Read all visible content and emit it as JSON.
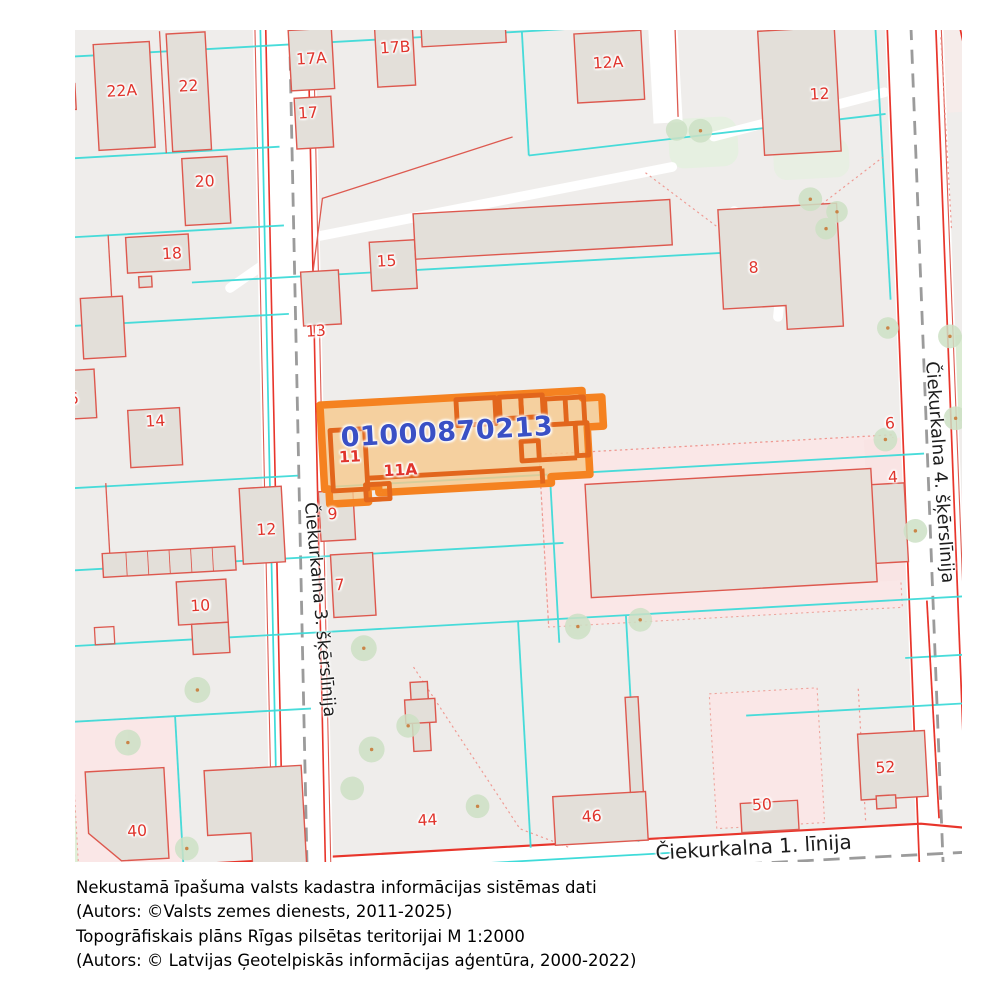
{
  "map": {
    "selected_parcel": {
      "cadastre_number": "01000870213",
      "house_numbers": [
        "11",
        "11A"
      ]
    },
    "streets": {
      "street_3": "Čiekurkalna 3. šķērslīnija",
      "street_4": "Čiekurkalna 4. šķērslīnija",
      "street_1": "Čiekurkalna 1. līnija"
    },
    "labels": [
      {
        "text": "22A"
      },
      {
        "text": "22"
      },
      {
        "text": "17A"
      },
      {
        "text": "17B"
      },
      {
        "text": "17"
      },
      {
        "text": "20"
      },
      {
        "text": "18"
      },
      {
        "text": "12A"
      },
      {
        "text": "12"
      },
      {
        "text": "15"
      },
      {
        "text": "13"
      },
      {
        "text": "8"
      },
      {
        "text": "16"
      },
      {
        "text": "14"
      },
      {
        "text": "7"
      },
      {
        "text": "6"
      },
      {
        "text": "4"
      },
      {
        "text": "9"
      },
      {
        "text": "7"
      },
      {
        "text": "12"
      },
      {
        "text": "10"
      },
      {
        "text": "11"
      },
      {
        "text": "11A"
      },
      {
        "text": "40"
      },
      {
        "text": "42"
      },
      {
        "text": "44"
      },
      {
        "text": "46"
      },
      {
        "text": "50"
      },
      {
        "text": "52"
      }
    ],
    "colors": {
      "highlight_border": "#F58220",
      "highlight_fill": "#F6C98E",
      "highlight_inner_lines": "#E2661C",
      "cadastre_text": "#3A50C5",
      "house_number_text": "#E0342C",
      "parcel_line_red": "#DD5A50",
      "street_line_red": "#E8352B",
      "survey_line_cyan": "#3FDBD9",
      "road_fill": "#FFFFFF",
      "road_dash_gray": "#9B9B9B",
      "background": "#EFEDEB",
      "building_fill": "#E3DFD9",
      "green_area": "#DFEED6",
      "pink_area": "#FAE7E7",
      "tree_fill": "#CDE1C5"
    }
  },
  "attribution": {
    "line1": "Nekustamā īpašuma valsts kadastra informācijas sistēmas dati",
    "line2": "(Autors: ©Valsts zemes dienests, 2011-2025)",
    "line3": "Topogrāfiskais plāns Rīgas pilsētas teritorijai M 1:2000",
    "line4": "(Autors: © Latvijas Ģeotelpiskās informācijas aģentūra, 2000-2022)"
  }
}
